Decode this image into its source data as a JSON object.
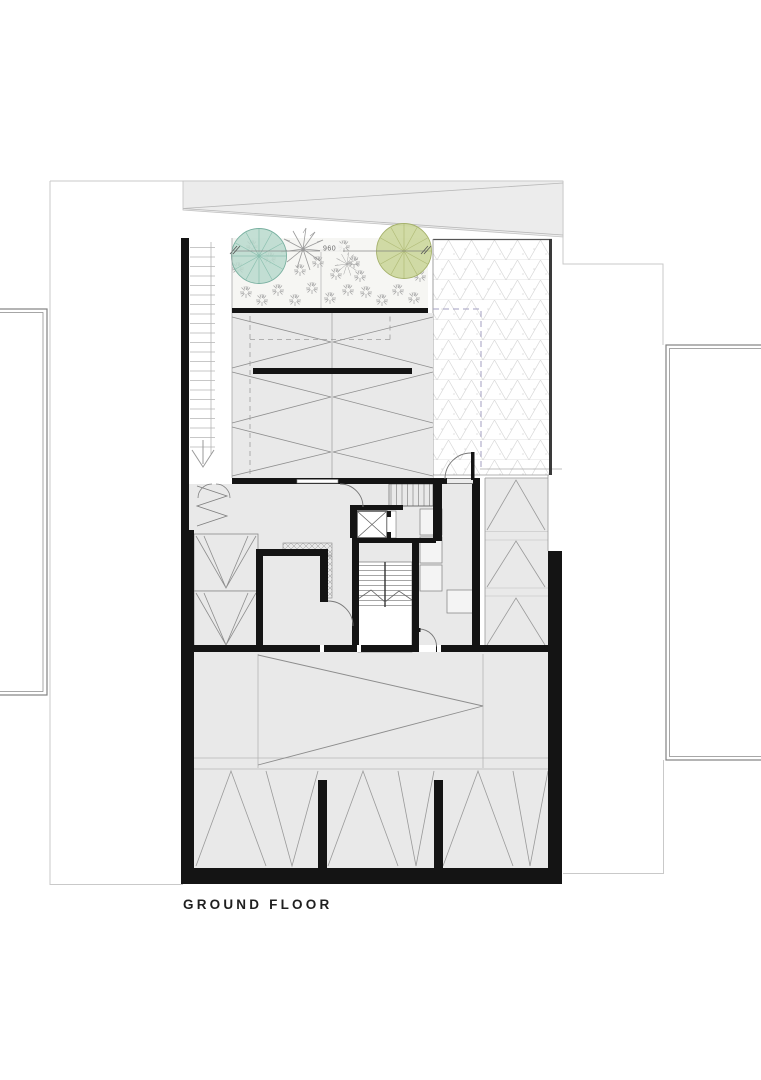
{
  "plan": {
    "floor_label": "GROUND FLOOR",
    "garden_dimension": "960",
    "colors": {
      "wall": "#141414",
      "room_fill": "#e9e9e9",
      "driveway_fill": "#ececec",
      "garden_fill": "#f6f6f3",
      "tree_teal": "#b9d9cd",
      "tree_teal_stroke": "#79b0a0",
      "tree_green": "#ccd79c",
      "tree_green_stroke": "#a5b16b",
      "shrub": "#a8a8a8",
      "pattern_line": "#979797",
      "grid_line": "#d9d9d9",
      "boundary_line": "#c9c9c9",
      "dashed_accent": "#a39fc0"
    },
    "symbols": [
      "deciduous-tree",
      "evergreen-tree",
      "shrub",
      "fern-plant",
      "elevator",
      "main-staircase",
      "entry-staircase",
      "ramp-down-arrow",
      "door-swing",
      "bifold-door",
      "kitchen-counter",
      "wardrobe",
      "table"
    ]
  }
}
